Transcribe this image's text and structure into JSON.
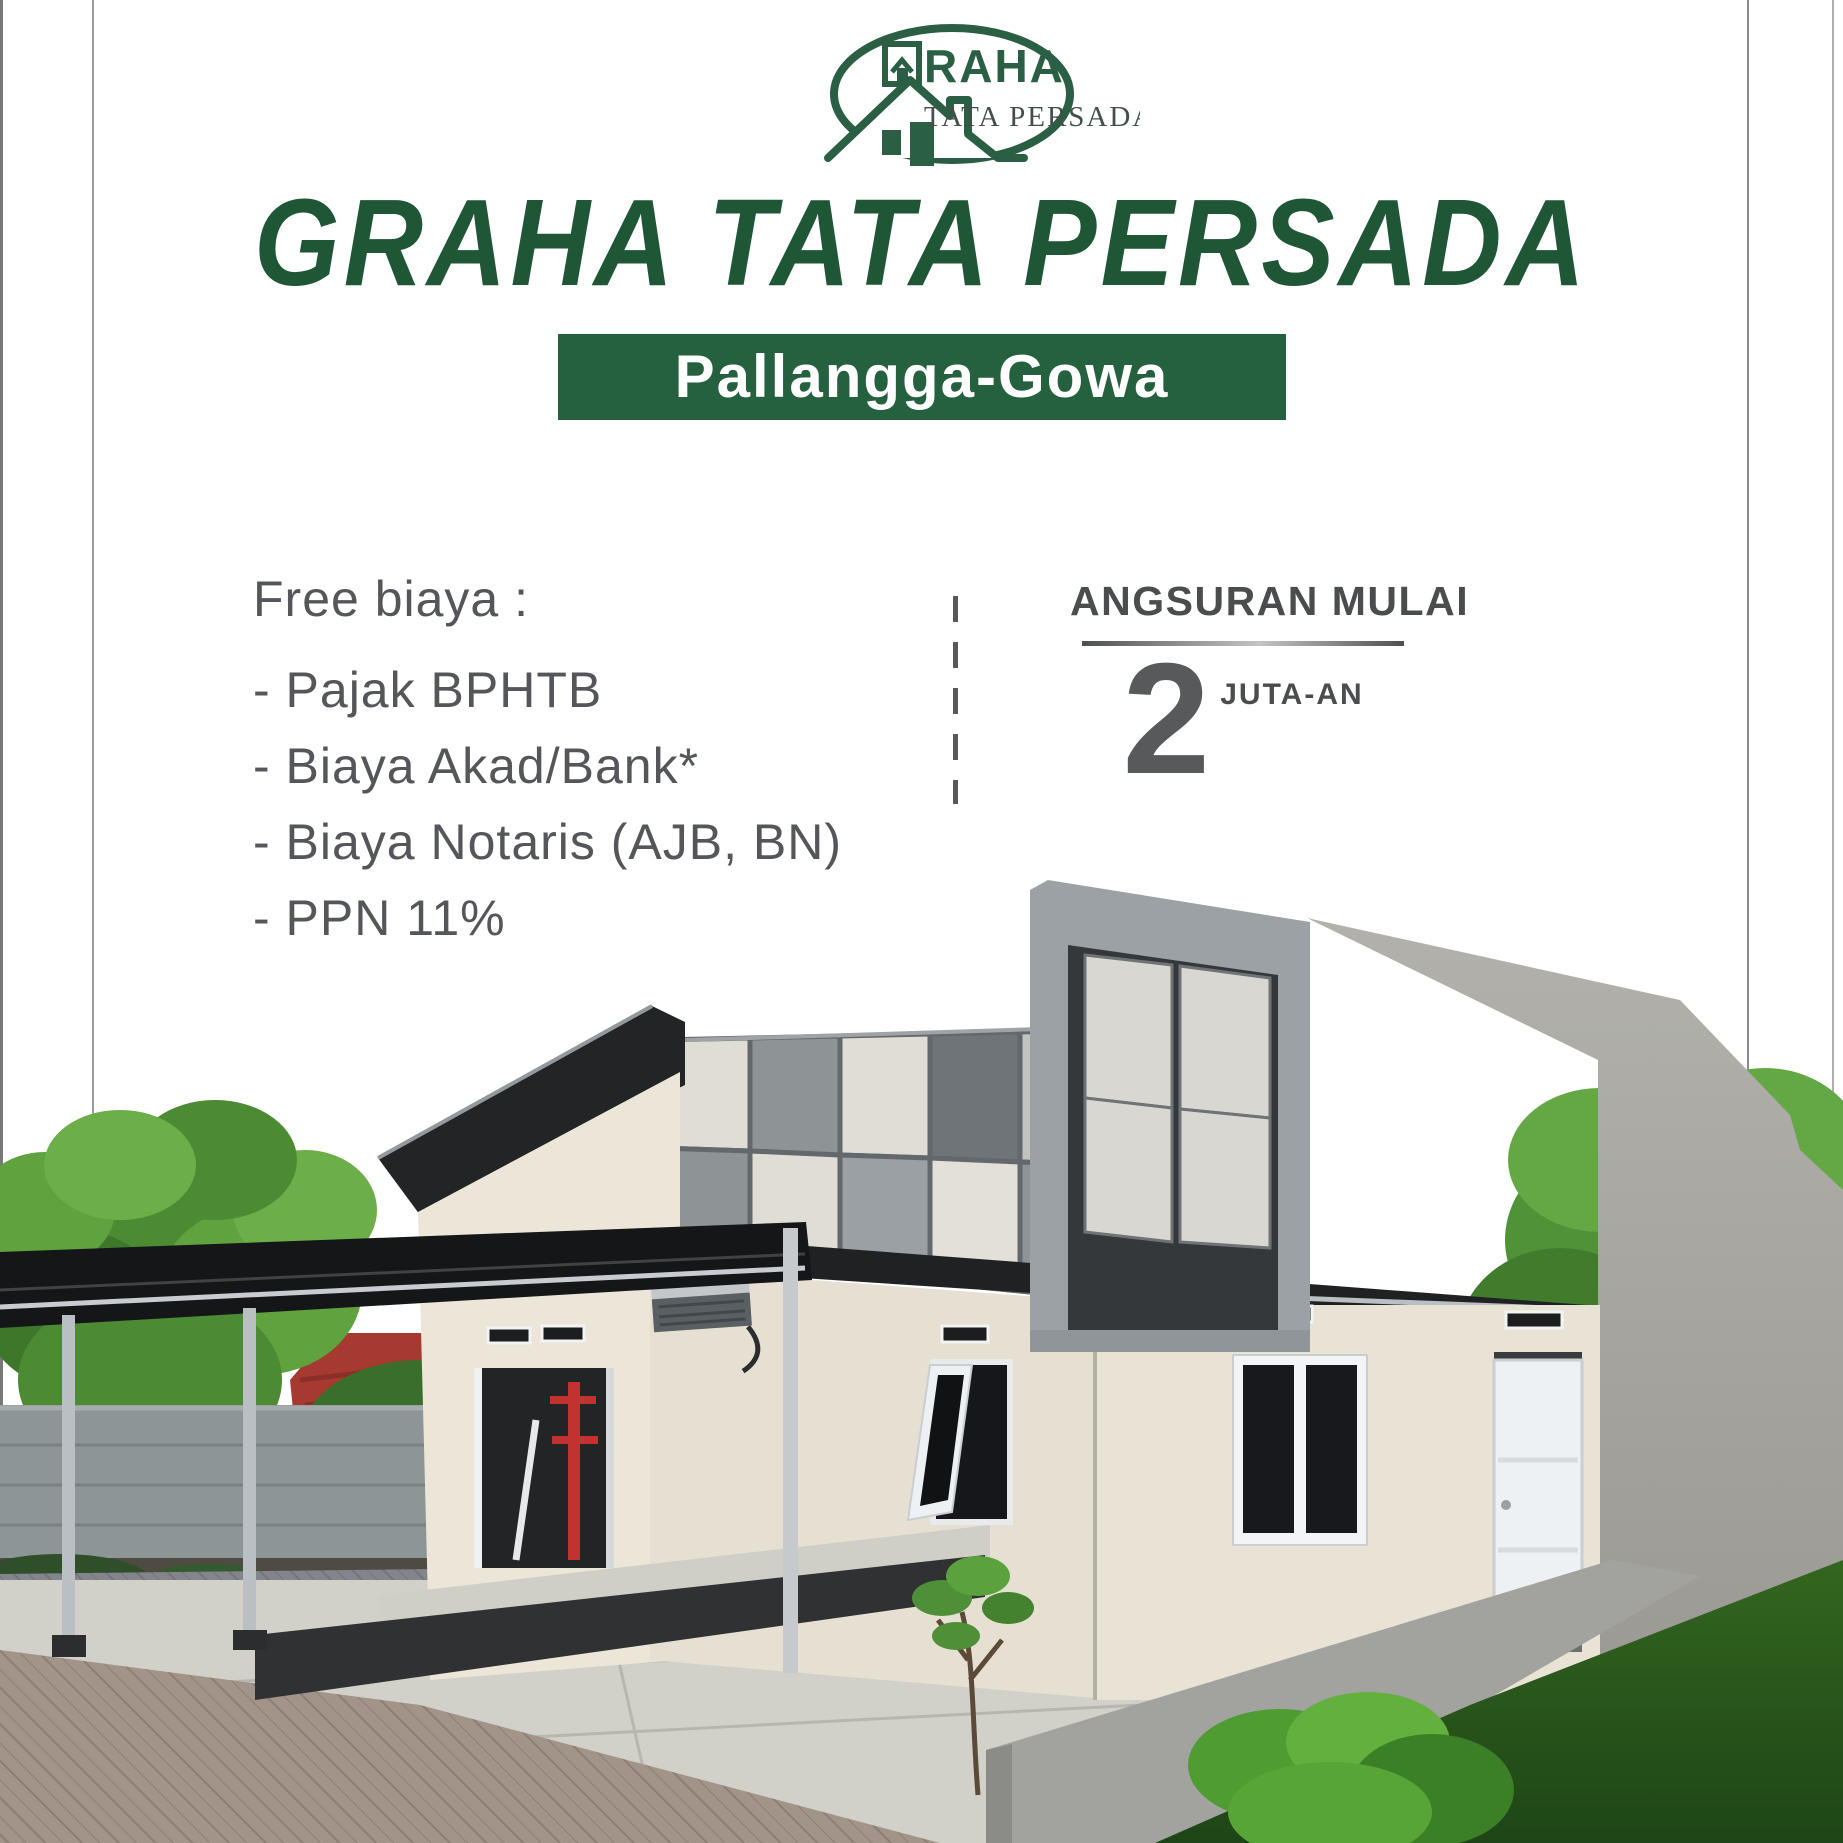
{
  "poster": {
    "logo": {
      "brand_top_full": "GRAHA",
      "brand_top_text": "RAHA",
      "brand_bottom": "TATA PERSADA"
    },
    "title": "GRAHA TATA PERSADA",
    "location_banner": "Pallangga-Gowa",
    "free_costs": {
      "heading": "Free biaya :",
      "items": [
        "- Pajak BPHTB",
        "- Biaya Akad/Bank*",
        "- Biaya Notaris (AJB, BN)",
        "- PPN 11%"
      ]
    },
    "installment": {
      "heading": "ANGSURAN MULAI",
      "amount": "2",
      "unit": "JUTA-AN"
    },
    "colors": {
      "brand_green": "#1F5635",
      "banner_green": "#25603F",
      "text_gray": "#55565A",
      "dark_gray": "#4B4C4E"
    }
  }
}
